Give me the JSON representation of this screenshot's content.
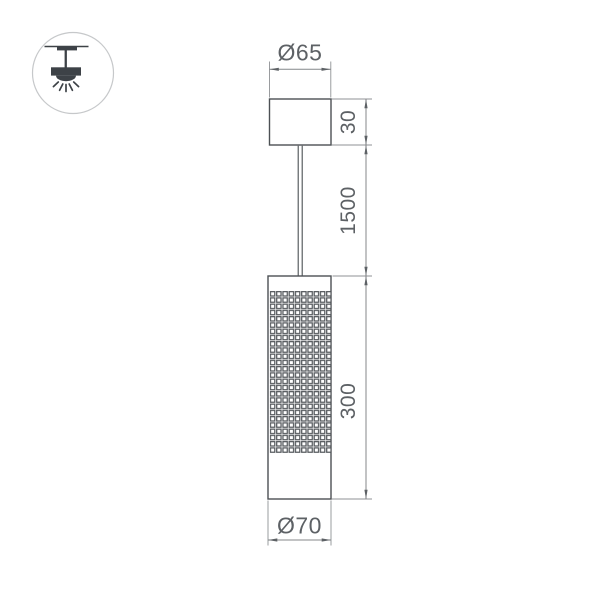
{
  "drawing": {
    "type": "pendant-luminaire-dimension-drawing",
    "dimensions": {
      "canopy_diameter": "Ø65",
      "canopy_height": "30",
      "suspension_length": "1500",
      "body_height": "300",
      "body_diameter": "Ø70"
    },
    "icon": "pendant-ceiling-light-icon",
    "colors": {
      "outline": "#4c5054",
      "dimension_line": "#84878a",
      "dimension_text": "#5d6165",
      "icon": "#3d4247",
      "icon_circle_border": "#c6c8ca",
      "background": "#ffffff"
    }
  }
}
